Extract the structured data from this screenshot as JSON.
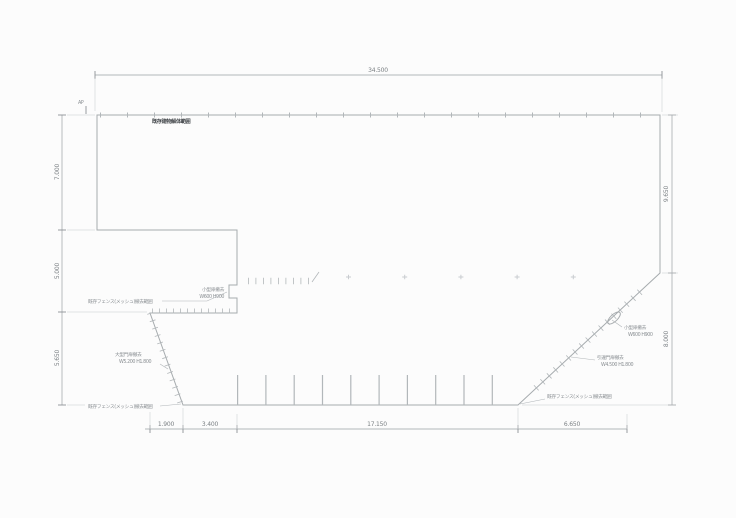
{
  "colors": {
    "background": "#fcfcfc",
    "plan_line": "#a6abae",
    "dimension_line": "#9aa0a4",
    "dimension_text": "#7b8084",
    "annotation_text": "#8a8f93",
    "title_text": "#42464a"
  },
  "dimensions": {
    "top_total": "34.500",
    "left": [
      "7.000",
      "5.000",
      "5.650"
    ],
    "right": [
      "9.650",
      "8.000"
    ],
    "bottom": [
      "1.900",
      "3.400",
      "17.150",
      "6.650"
    ]
  },
  "annotations": {
    "benchmark": "AP",
    "site_title": "既存建物解体範囲",
    "notch_gate": [
      "小型扉撤去",
      "W600 H900"
    ],
    "left_fence_upper": "既存フェンス(メッシュ)撤去範囲",
    "left_gate": [
      "大型門扉撤去",
      "W5.200 H1.800"
    ],
    "left_fence_lower": "既存フェンス(メッシュ)撤去範囲",
    "right_gate_small": [
      "小型扉撤去",
      "W600 H900"
    ],
    "right_gate_sliding": [
      "引違門扉撤去",
      "W4.500 H1.800"
    ],
    "right_fence": "既存フェンス(メッシュ)撤去範囲"
  }
}
